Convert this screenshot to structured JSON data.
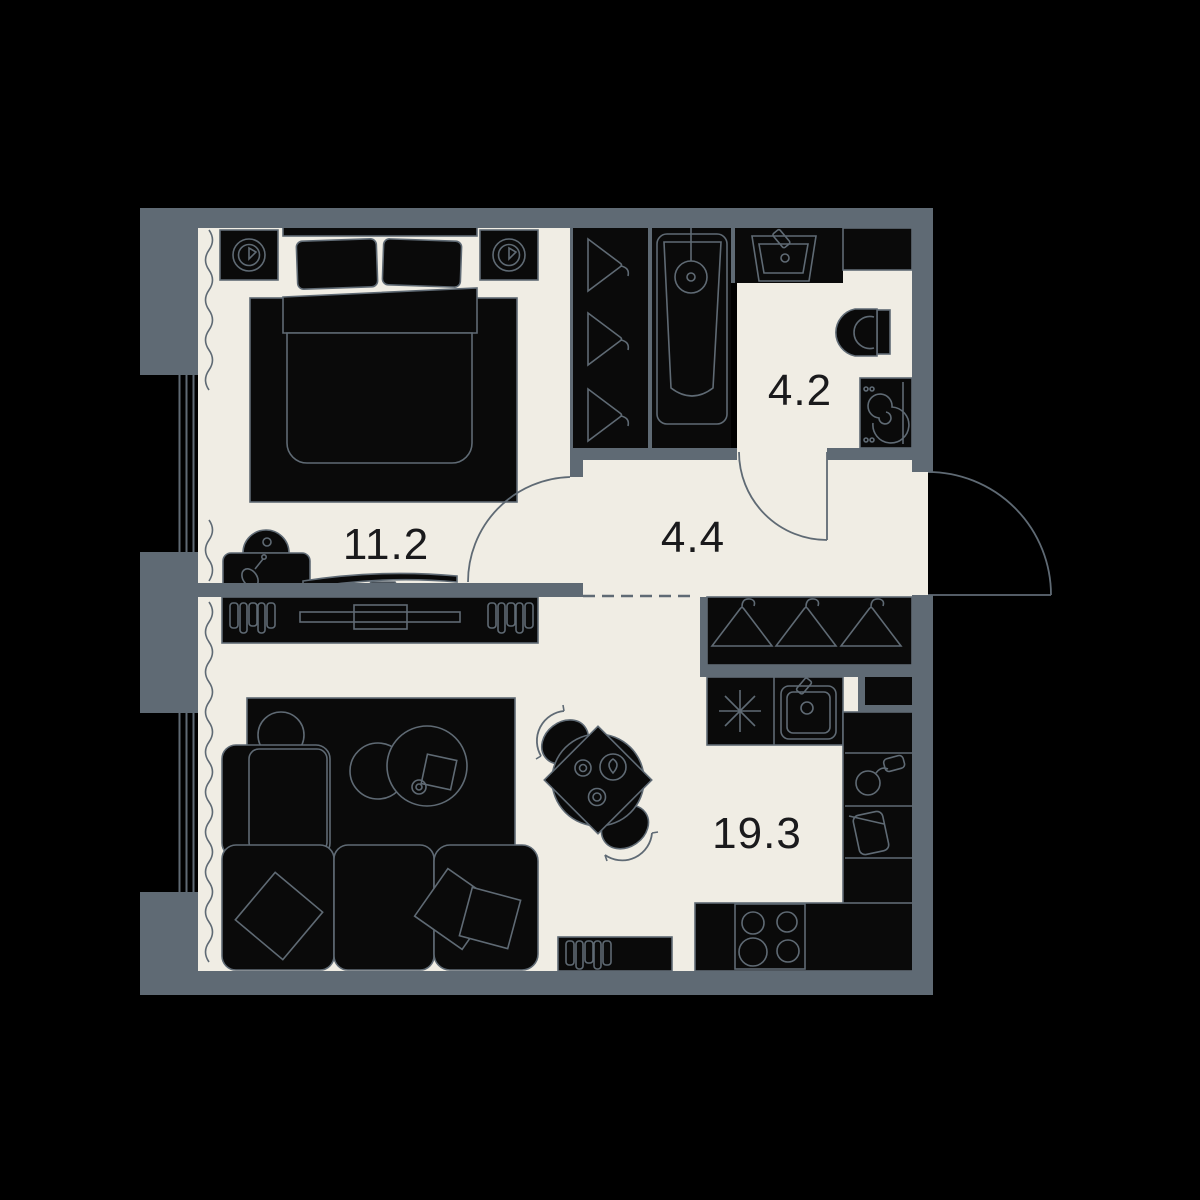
{
  "meta": {
    "title": "Apartment floor plan"
  },
  "colors": {
    "background": "#000000",
    "wall": "#5f6a74",
    "floor": "#f0ede4",
    "furniture_fill": "#0a0a0a",
    "outline": "#5f6a74",
    "label_ink": "#1a1a1c"
  },
  "rooms": [
    {
      "id": "bedroom",
      "area_label": "11.2",
      "furniture": [
        "nightstand-lamp",
        "nightstand-lamp",
        "double-bed",
        "rug",
        "vanity-table",
        "stool",
        "wall-tv",
        "curtain-window"
      ]
    },
    {
      "id": "hallway",
      "area_label": "4.4",
      "furniture": [
        "entrance-door",
        "bedroom-door",
        "bathroom-door"
      ]
    },
    {
      "id": "bathroom",
      "area_label": "4.2",
      "furniture": [
        "hanger-wardrobe",
        "bathtub-shower",
        "washbasin",
        "cabinet",
        "toilet",
        "washing-machine"
      ]
    },
    {
      "id": "living_kitchen",
      "area_label": "19.3",
      "furniture": [
        "media-console",
        "side-table",
        "rug",
        "coffee-tables",
        "corner-sofa",
        "pillows",
        "dining-table",
        "chairs",
        "hanger-closet",
        "kitchen-counter-hob-sink",
        "tall-kitchen-units",
        "kettle",
        "basket",
        "stove",
        "bookshelf",
        "curtain-window"
      ]
    }
  ]
}
